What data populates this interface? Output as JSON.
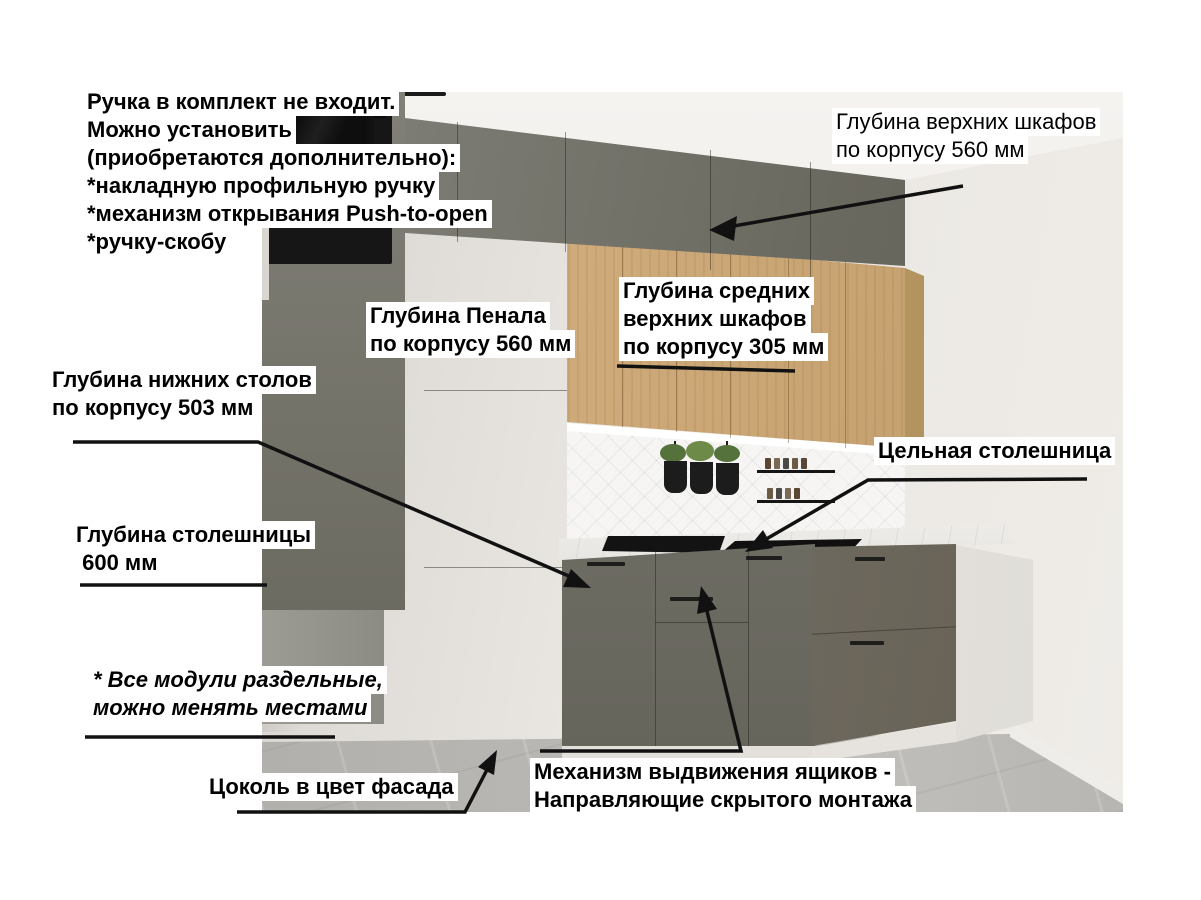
{
  "annotations": {
    "handle_note": {
      "lines": [
        "Ручка в комплект не входит.",
        "Можно установить",
        "(приобретаются дополнительно):",
        "*накладную профильную ручку",
        "*механизм открывания Push-to-open",
        "*ручку-скобу"
      ]
    },
    "upper_cabinets_depth": {
      "lines": [
        "Глубина верхних шкафов",
        "по корпусу 560 мм"
      ]
    },
    "tall_cabinet_depth": {
      "lines": [
        "Глубина Пенала",
        "по корпусу 560 мм"
      ]
    },
    "mid_upper_cabinets_depth": {
      "lines": [
        "Глубина средних",
        "верхних шкафов",
        "по корпусу 305 мм"
      ]
    },
    "base_cabinets_depth": {
      "lines": [
        "Глубина нижних столов",
        "по корпусу 503 мм"
      ]
    },
    "countertop_depth": {
      "lines": [
        "Глубина столешницы",
        " 600 мм"
      ]
    },
    "solid_countertop": {
      "lines": [
        "Цельная столешница"
      ]
    },
    "modules_note": {
      "lines": [
        "* Все модули раздельные,",
        "можно менять местами"
      ]
    },
    "plinth_note": {
      "lines": [
        "Цоколь в цвет фасада"
      ]
    },
    "drawer_mechanism": {
      "lines": [
        "Механизм выдвижения ящиков -",
        "Направляющие скрытого монтажа"
      ]
    }
  },
  "colors": {
    "annotation_text": "#000000",
    "annotation_bg": "#ffffff",
    "arrow": "#111111",
    "facade_graphite": "#6f6e65",
    "facade_wood": "#cda877",
    "countertop_marble": "#edebe8",
    "wall": "#e9e6e1",
    "floor": "#b5b3af"
  }
}
